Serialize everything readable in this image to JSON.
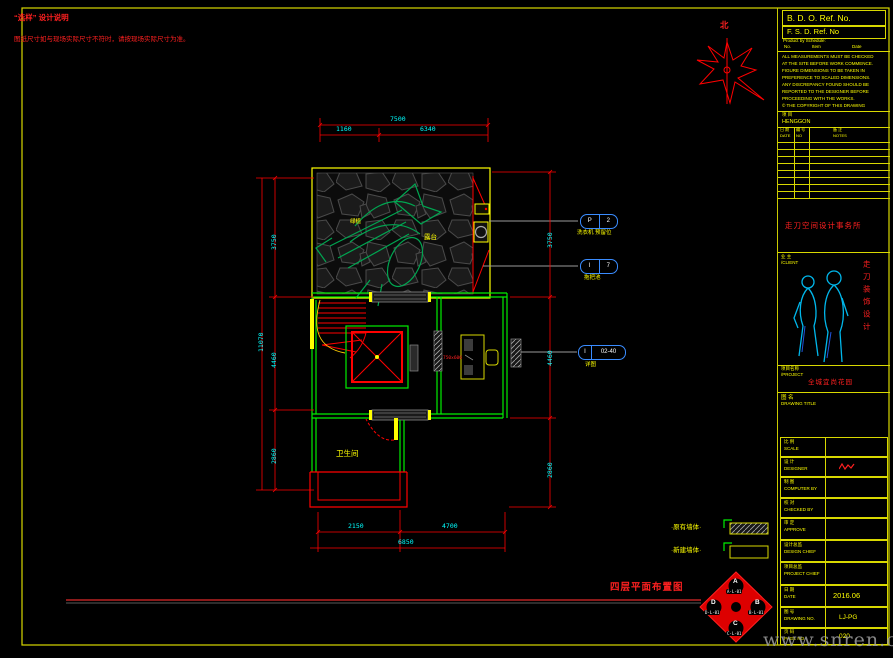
{
  "colors": {
    "wall_green": "#00ff00",
    "dim_red": "#ff0000",
    "dim_text_cyan": "#00ffff",
    "accent_yellow": "#ffff00",
    "callout_blue": "#3a8cff",
    "keyplan_red": "#dd0000"
  },
  "notes": {
    "title": "“选样” 设计说明",
    "body": "图纸尺寸如与现场实际尺寸不符时，请按现场实际尺寸为准。"
  },
  "north": {
    "label": "北"
  },
  "plan": {
    "labels": {
      "plant": "绿植",
      "terrace": "露台",
      "bathroom": "卫生间",
      "desk_note": "750x600"
    },
    "callouts": [
      {
        "left": "P",
        "right": "2",
        "label": "洗衣机 预留位"
      },
      {
        "left": "I",
        "right": "7",
        "label": "拖把池"
      },
      {
        "left": "I",
        "right": "02-40",
        "label": "详图"
      }
    ],
    "dims": {
      "top": {
        "overall": "7500",
        "seg1": "1160",
        "seg2": "6340"
      },
      "left": {
        "overall": "11070",
        "seg1": "3750",
        "seg2": "4460",
        "seg3": "2860"
      },
      "right": {
        "seg1": "3750",
        "seg2": "4460",
        "seg3": "2860"
      },
      "bottom": {
        "overall": "6850",
        "seg1": "2150",
        "seg2": "4700"
      }
    }
  },
  "legend": {
    "item1": "·原有墙体·",
    "item2": "·新建墙体·"
  },
  "footer": {
    "drawing_title": "四层平面布置图"
  },
  "keyplan": {
    "a": "A",
    "a_code": "A-L-01",
    "b": "B",
    "b_code": "B-L-01",
    "c": "C",
    "c_code": "C-L-01",
    "d": "D",
    "d_code": "D-L-01"
  },
  "titleblock": {
    "bdo": "B. D. O. Ref. No.",
    "fsd": "F. S. D. Ref. No",
    "product": "Product by Schedule:",
    "col_no": "No.",
    "col_item": "Item",
    "col_date": "Date",
    "notes": [
      "ALL MEASUREMENTS MUST BE CHECKED",
      "AT THE SITE BEFORE WORK COMMENCE.",
      "FIGURE DIMENSIONS TO BE TAKEN IN",
      "PREFERENCE TO SCALED DIMENSIONS.",
      "ANY DISCREPANCY FOUND SHOULD BE",
      "REPORTED TO THE DESIGNER BEFORE",
      "PROCEEDING WITH THE WORKS.",
      "© THE COPYRIGHT OF THIS DRAWING"
    ],
    "proj_label": "项 目",
    "proj_value": "HENGGON",
    "log_date_cn": "日 期",
    "log_date_en": "DATE",
    "log_no_cn": "编 号",
    "log_no_en": "NO",
    "log_notes_cn": "备 注",
    "log_notes_en": "NOTES",
    "company": "走刀空间设计事务所",
    "client_cn": "业 主",
    "client_en": "/CLIENT",
    "brand_vertical": "走刀装饰设计",
    "pname_cn": "项目名称",
    "pname_en": "/PROJECT",
    "pname_value": "全城宜尚花园",
    "rows": [
      {
        "cn": "图 名",
        "en": "DRAWING TITLE",
        "value": ""
      },
      {
        "cn": "比 例",
        "en": "SCALE",
        "value": ""
      },
      {
        "cn": "设 计",
        "en": "DESIGNER",
        "value": ""
      },
      {
        "cn": "制 图",
        "en": "COMPUTER BY",
        "value": ""
      },
      {
        "cn": "校 对",
        "en": "CHECKED BY",
        "value": ""
      },
      {
        "cn": "审 定",
        "en": "APPROVE",
        "value": ""
      },
      {
        "cn": "设计总监",
        "en": "DESIGN CHIEF",
        "value": ""
      },
      {
        "cn": "项目总监",
        "en": "PROJECT CHIEF",
        "value": ""
      },
      {
        "cn": "日 期",
        "en": "DATE",
        "value": "2016.06"
      },
      {
        "cn": "图 号",
        "en": "DRAWING NO.",
        "value": "LJ-PG"
      },
      {
        "cn": "页 码",
        "en": "PAGE NO.",
        "value": "020"
      }
    ]
  },
  "watermark": "www.snren.com"
}
